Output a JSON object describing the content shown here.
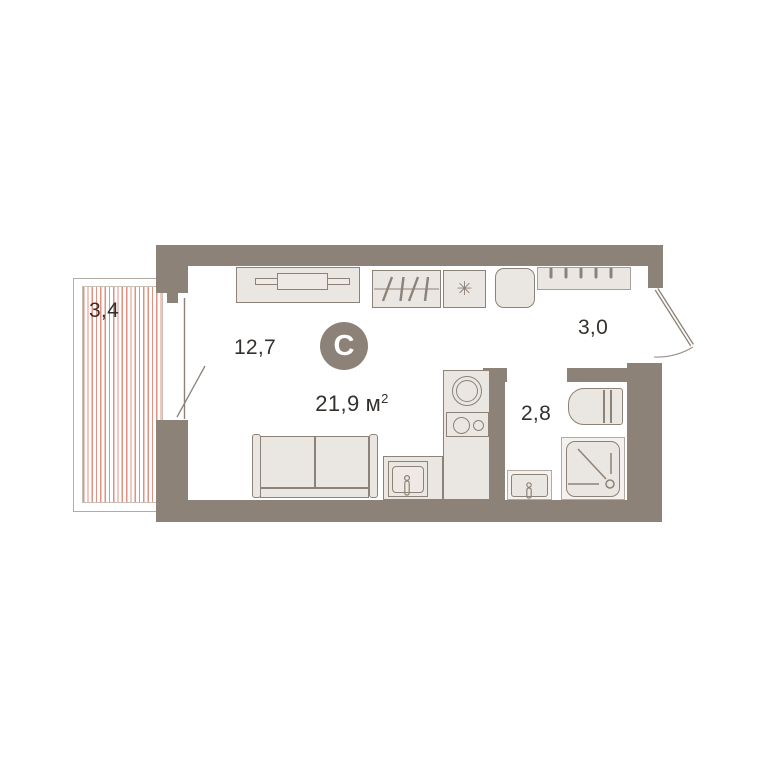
{
  "plan": {
    "badge": {
      "letter": "С"
    },
    "total_area": {
      "value": "21,9",
      "unit": "м",
      "superscript": "2"
    },
    "rooms": {
      "balcony": {
        "label": "3,4"
      },
      "living_room": {
        "label": "12,7"
      },
      "hallway": {
        "label": "3,0"
      },
      "bathroom": {
        "label": "2,8"
      }
    },
    "symbols": {
      "appliance_asterisk": "✳"
    },
    "colors": {
      "wall": "#8d8278",
      "furniture_fill": "#eae6e1",
      "furniture_stroke": "#8d8278",
      "balcony_hatch": "#e2907f",
      "light_border": "#b3aaa2",
      "badge_background": "#8d8278",
      "badge_text": "#ffffff",
      "label_text": "#33302d",
      "background": "#ffffff"
    }
  }
}
